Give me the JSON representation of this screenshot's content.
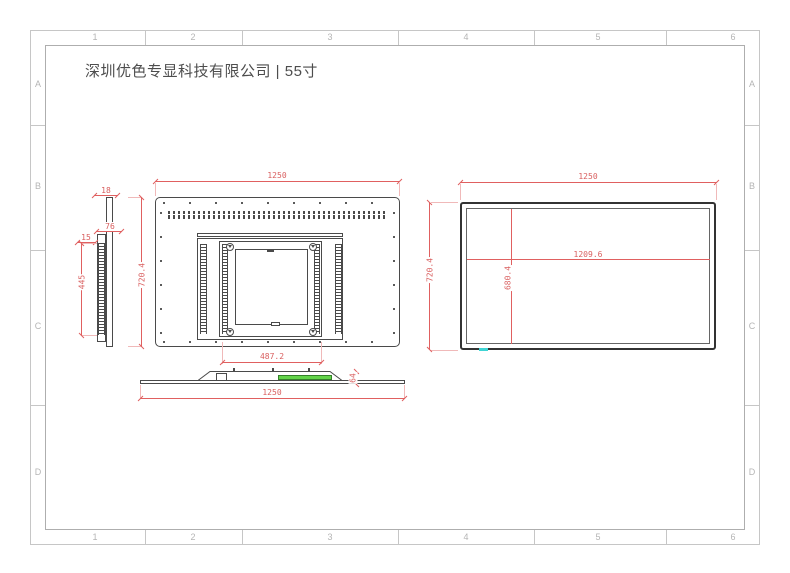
{
  "title": "深圳优色专显科技有限公司 | 55寸",
  "grid": {
    "cols": [
      "1",
      "2",
      "3",
      "4",
      "5",
      "6"
    ],
    "rows": [
      "A",
      "B",
      "C",
      "D"
    ]
  },
  "dims": {
    "front_width": "1250",
    "front_height": "720.4",
    "plate_width": "487.2",
    "side_thickness": "18",
    "side_depth": "76",
    "side_step": "15",
    "side_box_height": "445",
    "bottom_width": "1250",
    "bottom_depth": "64",
    "back_width": "1250",
    "back_height": "720.4",
    "active_width": "1209.6",
    "active_height": "680.4"
  },
  "colors": {
    "dimension_red": "#e06060",
    "drawing_line": "#4a4a4a",
    "grid_gray": "#c6c6c6",
    "highlight_green": "#63d44a",
    "highlight_cyan": "#3fd4d4"
  }
}
